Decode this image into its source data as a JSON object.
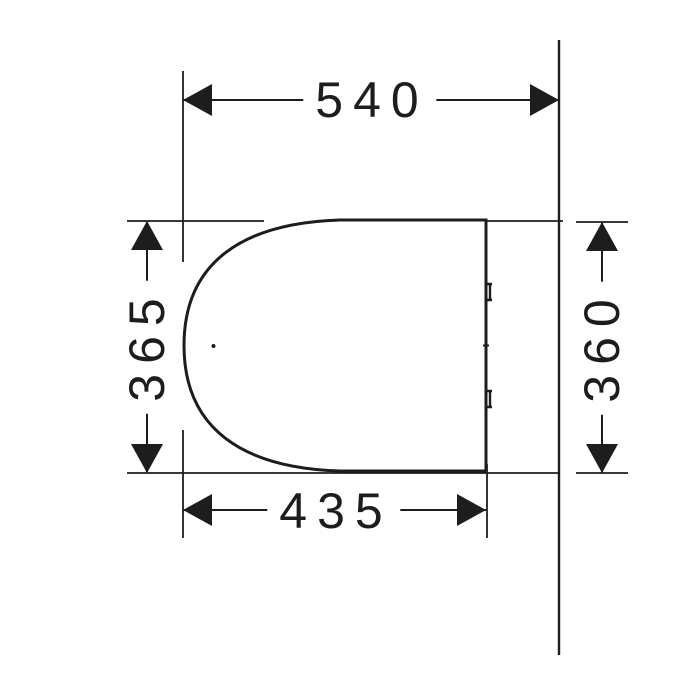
{
  "drawing": {
    "subject": "toilet-seat-top-view-technical-drawing",
    "dimension_top": "540",
    "dimension_bottom": "435",
    "dimension_left": "365",
    "dimension_right": "360"
  },
  "colors": {
    "line": "#1d1d1b",
    "background": "#ffffff"
  }
}
